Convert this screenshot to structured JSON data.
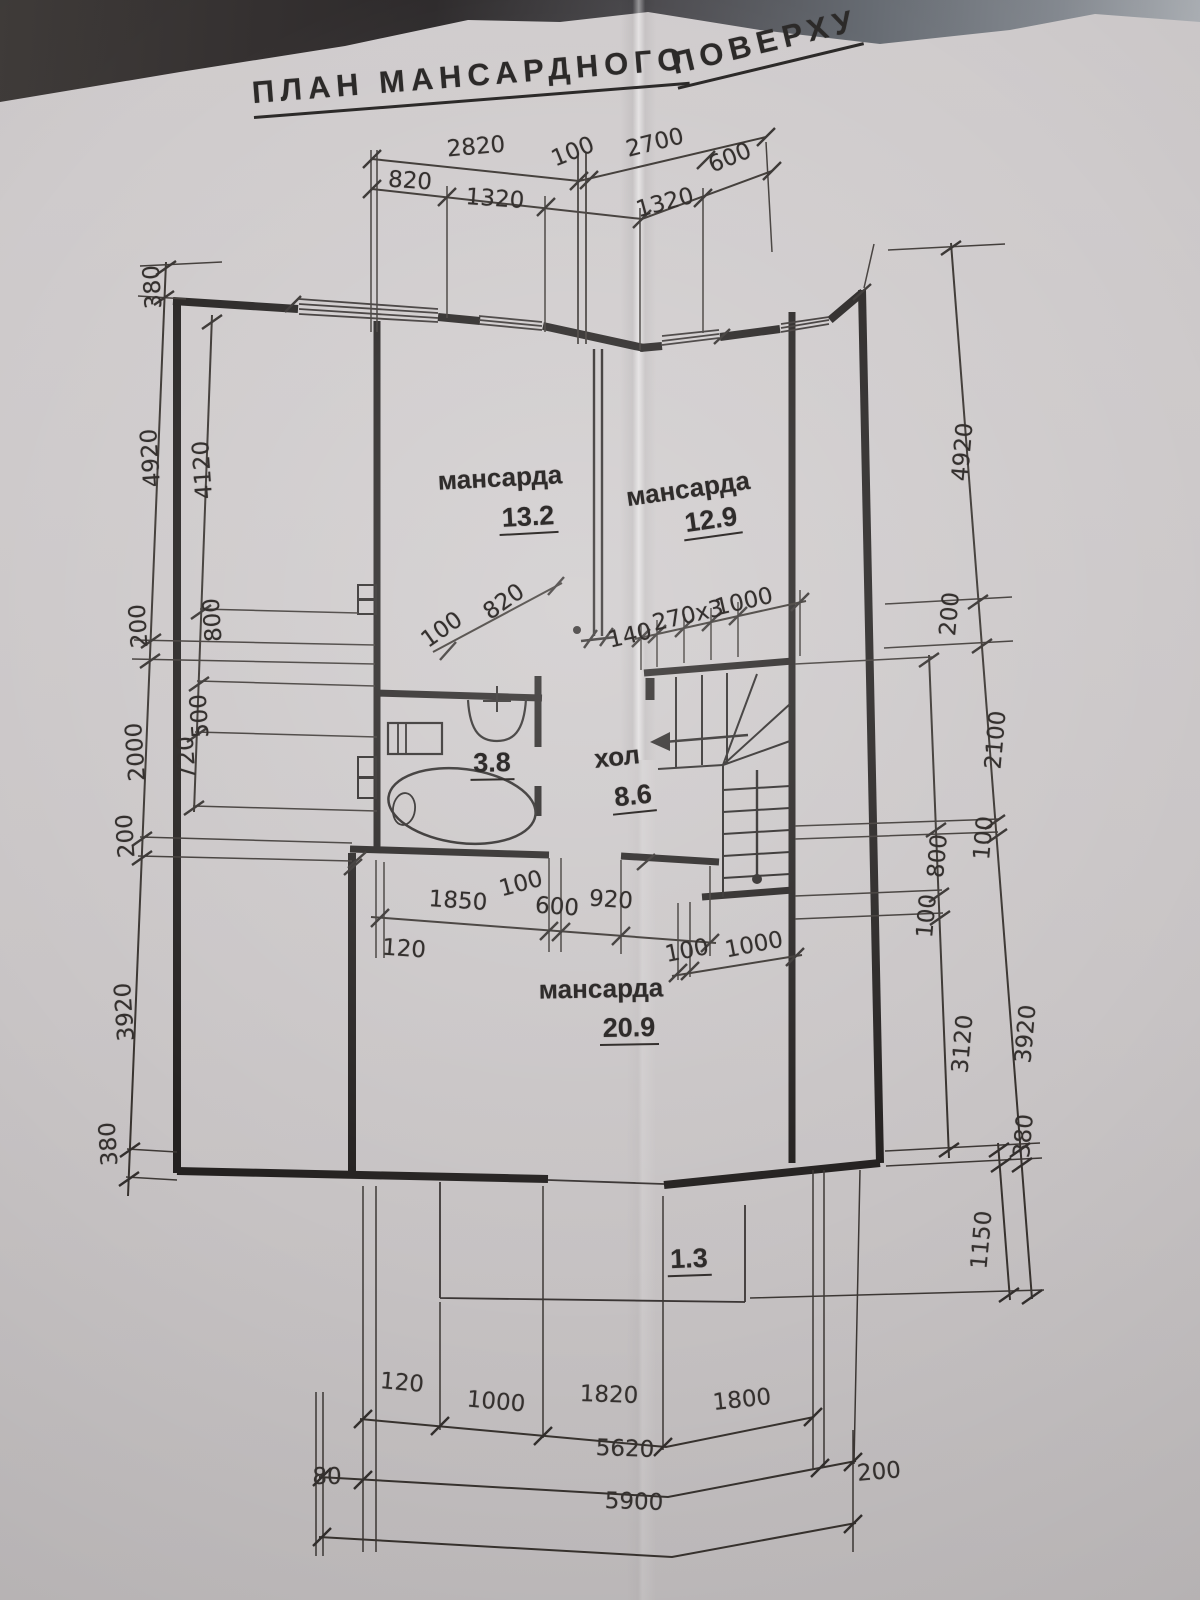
{
  "title": {
    "part1": "ПЛАН МАНСАРДНОГО",
    "part2": "ПОВЕРХУ"
  },
  "rooms": {
    "mansarda1": {
      "name": "мансарда",
      "area": "13.2"
    },
    "mansarda2": {
      "name": "мансарда",
      "area": "12.9"
    },
    "bathroom": {
      "area": "3.8"
    },
    "hall": {
      "name": "хол",
      "area": "8.6"
    },
    "mansarda3": {
      "name": "мансарда",
      "area": "20.9"
    },
    "balcony": {
      "area": "1.3"
    }
  },
  "dims": {
    "top": {
      "d2820": "2820",
      "d100": "100",
      "d2700": "2700",
      "d600": "600",
      "d820": "820",
      "d1320a": "1320",
      "d1320b": "1320"
    },
    "left_outer": {
      "d380t": "380",
      "d4920": "4920",
      "d200a": "200",
      "d2000": "2000",
      "d200b": "200",
      "d3920": "3920",
      "d380b": "380"
    },
    "left_inner": {
      "d4120": "4120",
      "d800": "800",
      "d500": "500",
      "d720": "720"
    },
    "right_outer": {
      "d4920": "4920",
      "d200": "200",
      "d2100": "2100",
      "d100": "100",
      "d3920": "3920",
      "d380": "380",
      "d1150": "1150"
    },
    "right_inner": {
      "d800": "800",
      "d100": "100",
      "d3120": "3120"
    },
    "attic_diag": {
      "d100": "100",
      "d820": "820"
    },
    "stair_top": {
      "d140": "140",
      "d270x3": "270x3",
      "d1000": "1000"
    },
    "mid": {
      "d1850": "1850",
      "d100": "100",
      "d600": "600",
      "d920": "920",
      "d120": "120"
    },
    "stair_bottom": {
      "d100": "100",
      "d1000": "1000"
    },
    "bottom_row1": {
      "d120": "120",
      "d1000": "1000",
      "d1820": "1820",
      "d1800": "1800"
    },
    "bottom_row2": {
      "d80": "80",
      "d5620": "5620",
      "d200": "200"
    },
    "bottom_row3": {
      "d5900": "5900"
    }
  }
}
